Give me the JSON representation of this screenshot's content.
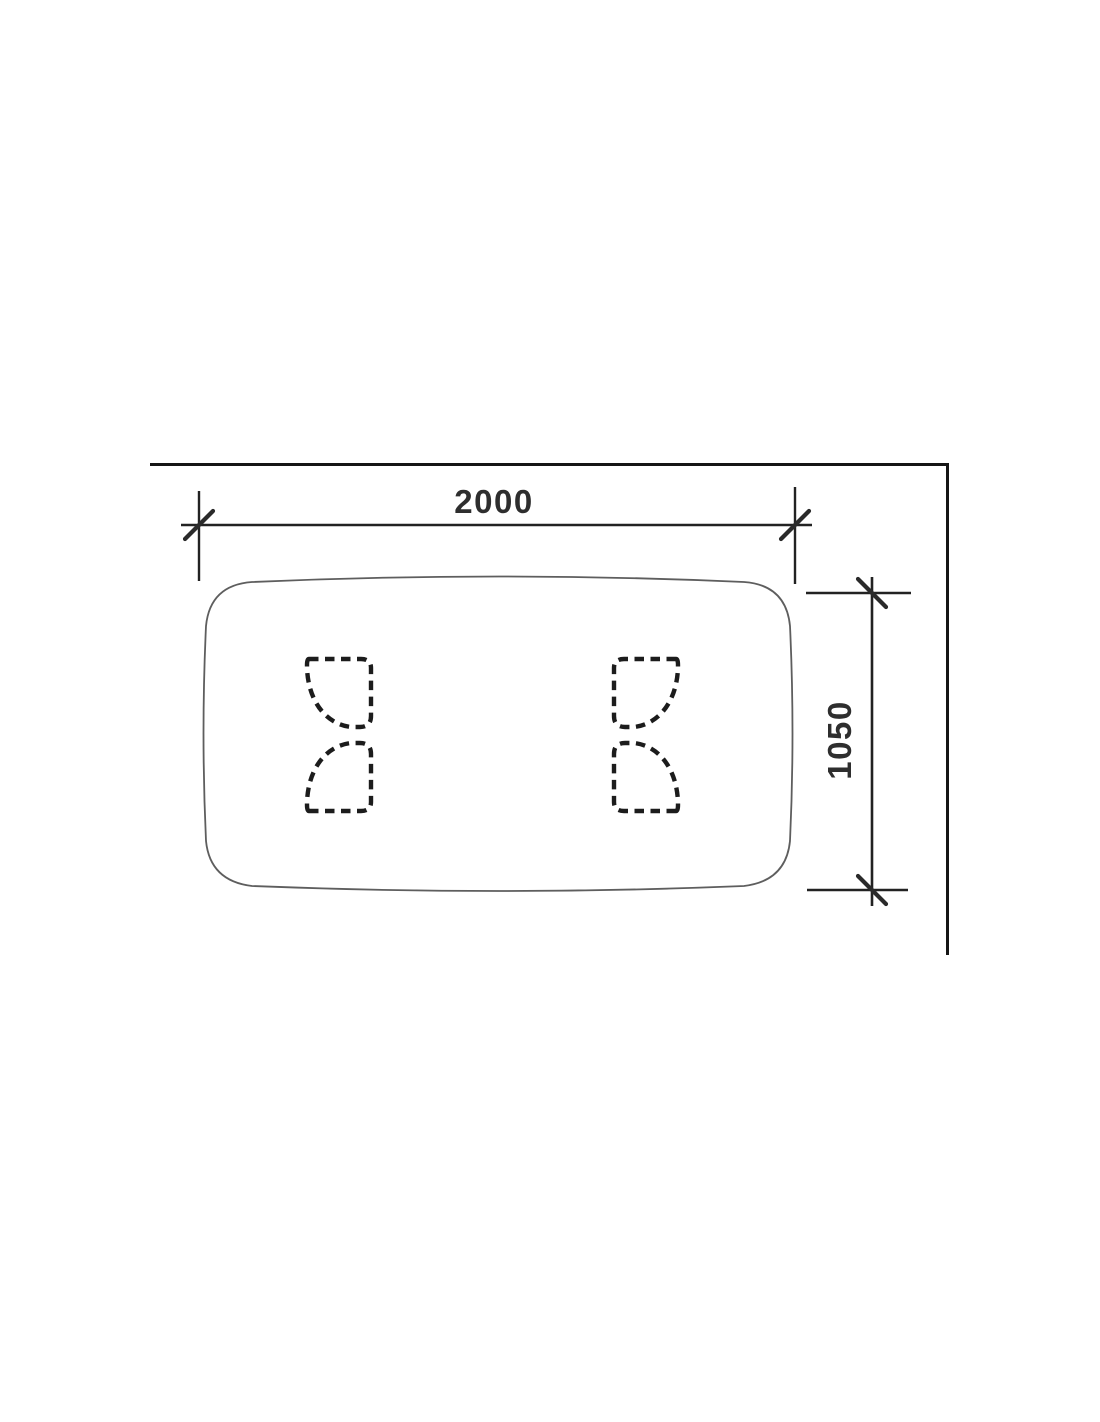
{
  "drawing": {
    "type": "technical-dimension-drawing",
    "subject": "table-top-plan-view",
    "width_dimension": {
      "label": "2000"
    },
    "height_dimension": {
      "label": "1050"
    },
    "colors": {
      "background": "#ffffff",
      "frame_line": "#161616",
      "dimension_line": "#222222",
      "tabletop_outline": "#5e5e5e",
      "hidden_leg_line": "#1c1c1c",
      "label_text": "#2e2e2e"
    }
  }
}
